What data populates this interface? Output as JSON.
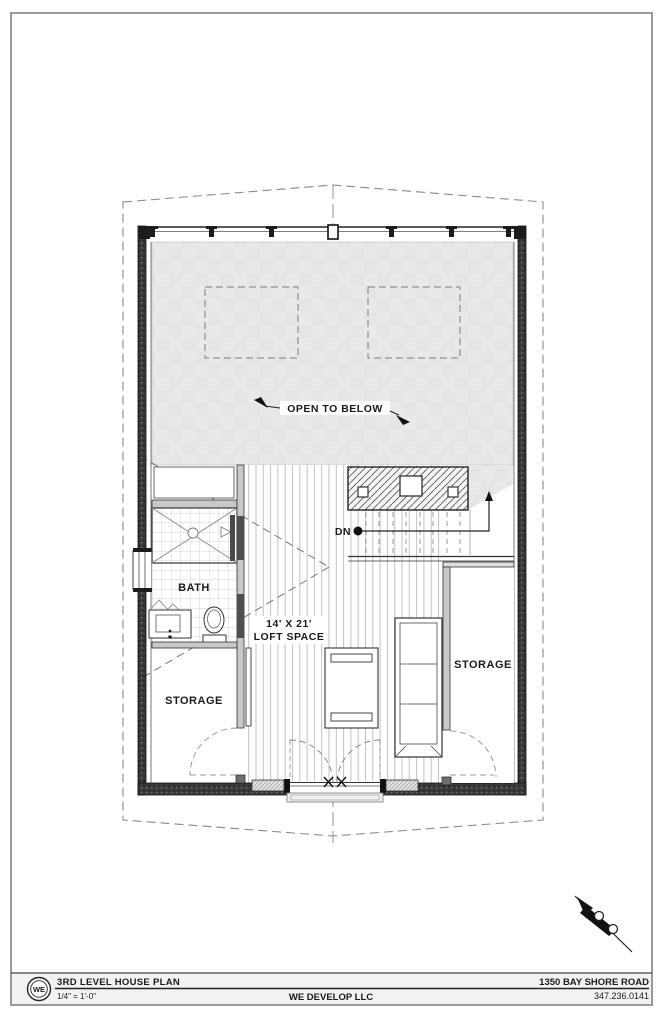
{
  "titleblock": {
    "logo": "WE",
    "sheet_title": "3RD LEVEL HOUSE PLAN",
    "scale": "1/4\" = 1'-0\"",
    "company": "WE DEVELOP LLC",
    "address": "1350 BAY SHORE ROAD",
    "phone": "347.236.0141"
  },
  "plan": {
    "labels": {
      "open_to_below": "OPEN TO BELOW",
      "bath": "BATH",
      "loft_dimensions": "14' X 21'",
      "loft_name": "LOFT SPACE",
      "down": "DN",
      "storage_left": "STORAGE",
      "storage_right": "STORAGE"
    },
    "colors": {
      "open_area_fill": "#e9e9e9",
      "wall_dark": "#2e2e2e",
      "wall_light": "#c8c8c8",
      "line": "#333333",
      "titleblock_fill": "#f2f2f2"
    }
  }
}
